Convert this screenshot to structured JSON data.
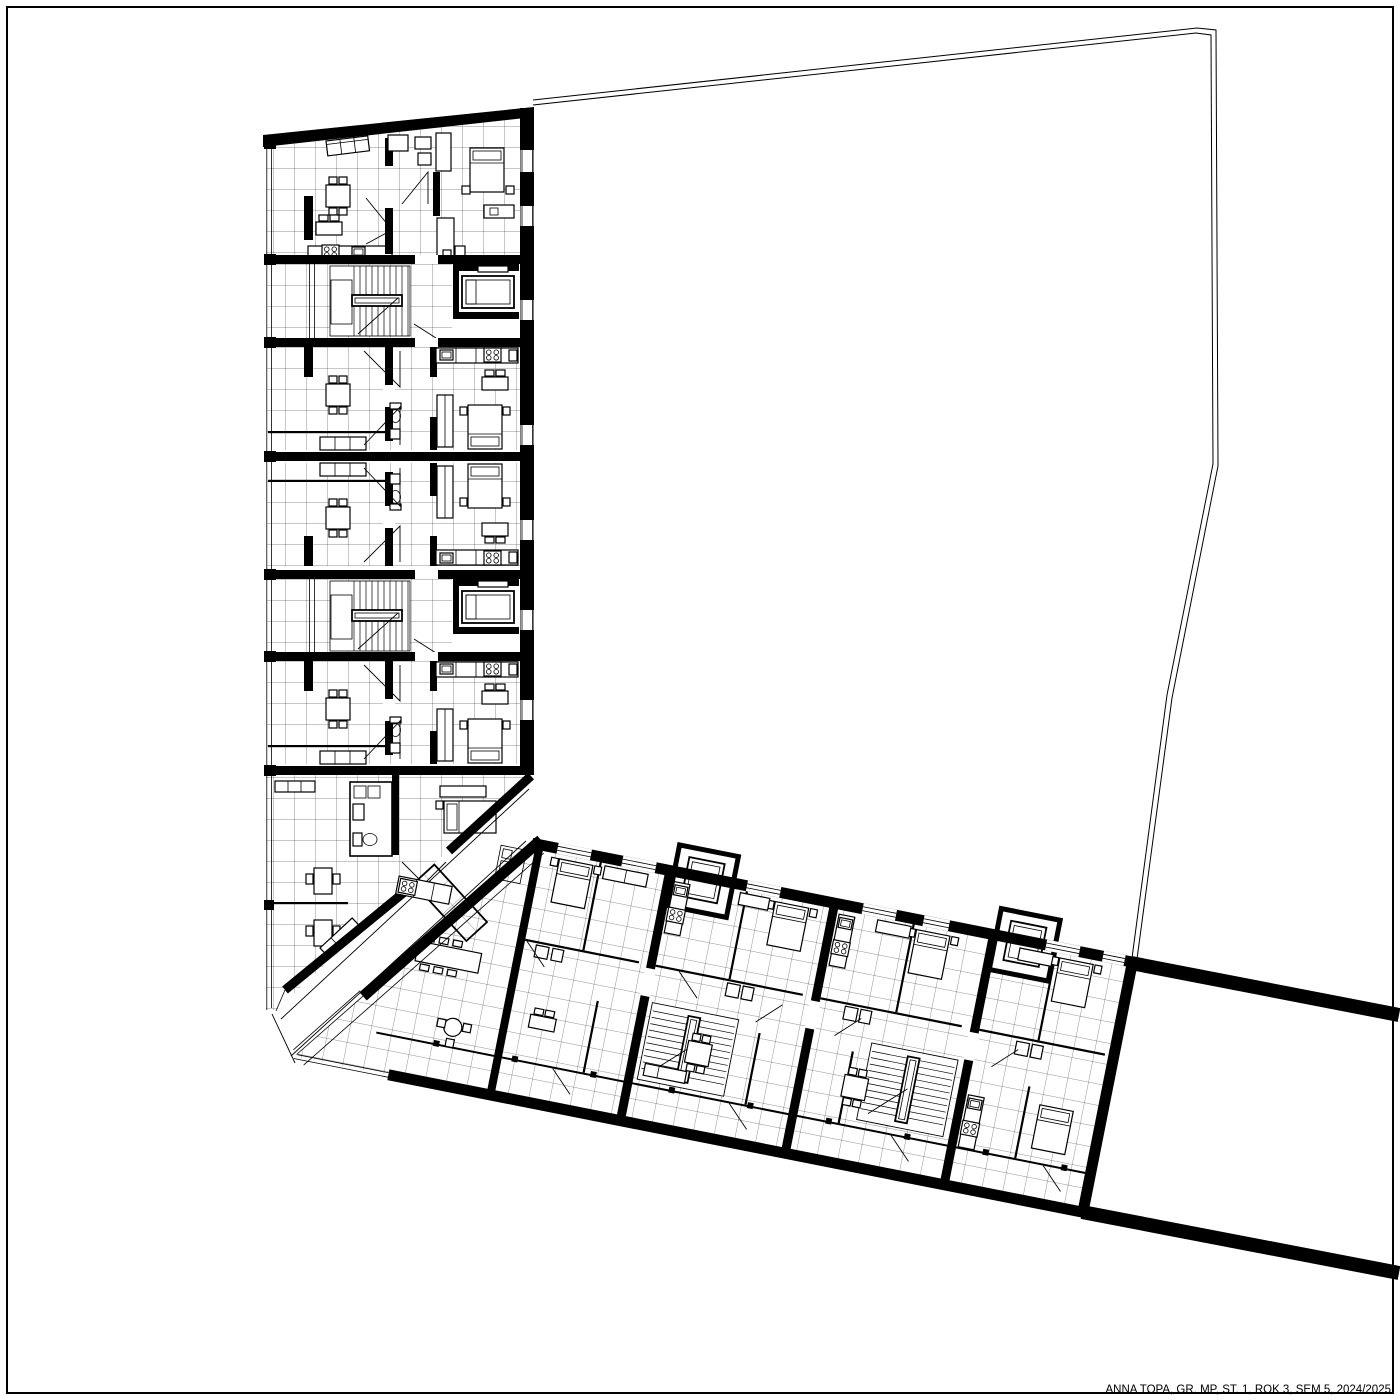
{
  "title_block": {
    "text": "ANNA TOPA, GR. MP, ST. 1, ROK 3, SEM 5, 2024/2025"
  },
  "colors": {
    "ink": "#000000",
    "paper": "#ffffff"
  }
}
